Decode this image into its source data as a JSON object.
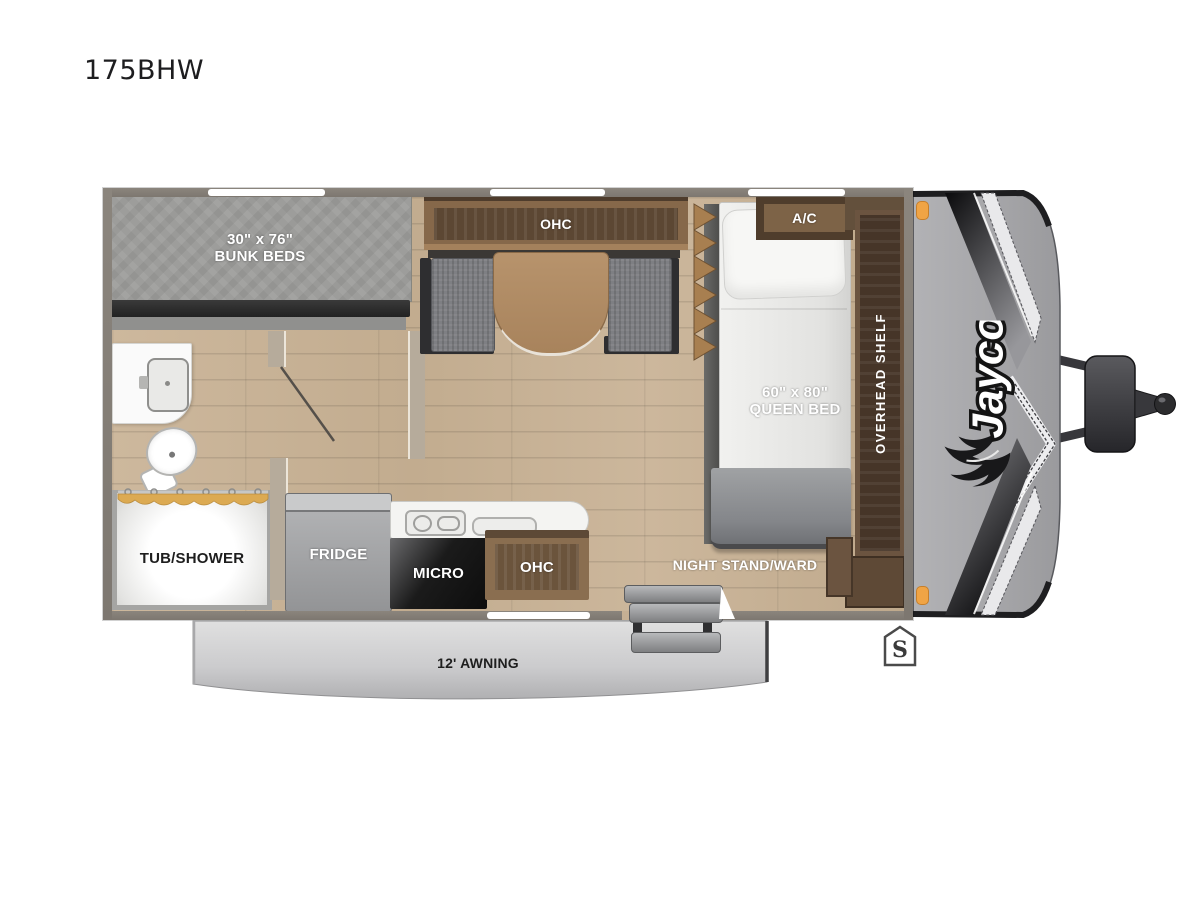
{
  "title": "175BHW",
  "brand": "Jayco",
  "labels": {
    "bunk_size": "30\" x 76\"",
    "bunk_name": "BUNK BEDS",
    "dinette_ohc": "OHC",
    "ac": "A/C",
    "queen_size": "60\" x 80\"",
    "queen_name": "QUEEN BED",
    "overhead_shelf": "OVERHEAD SHELF",
    "tub_shower": "TUB/SHOWER",
    "fridge": "FRIDGE",
    "micro": "MICRO",
    "kitchen_ohc": "OHC",
    "night_stand": "NIGHT STAND/WARD",
    "awning": "12' AWNING",
    "spare": "S"
  },
  "colors": {
    "wall_gray": "#847e76",
    "floor_wood": "#c9b499",
    "cabinet_brown": "#86684a",
    "cabinet_dark_brown": "#5c4733",
    "mattress_gray": "#9c9c9a",
    "counter_white": "#f3f3f1",
    "marker_orange": "#f0a445",
    "awning_gray": "#cfcfcf",
    "front_cap_gray": "#a7a7aa"
  }
}
